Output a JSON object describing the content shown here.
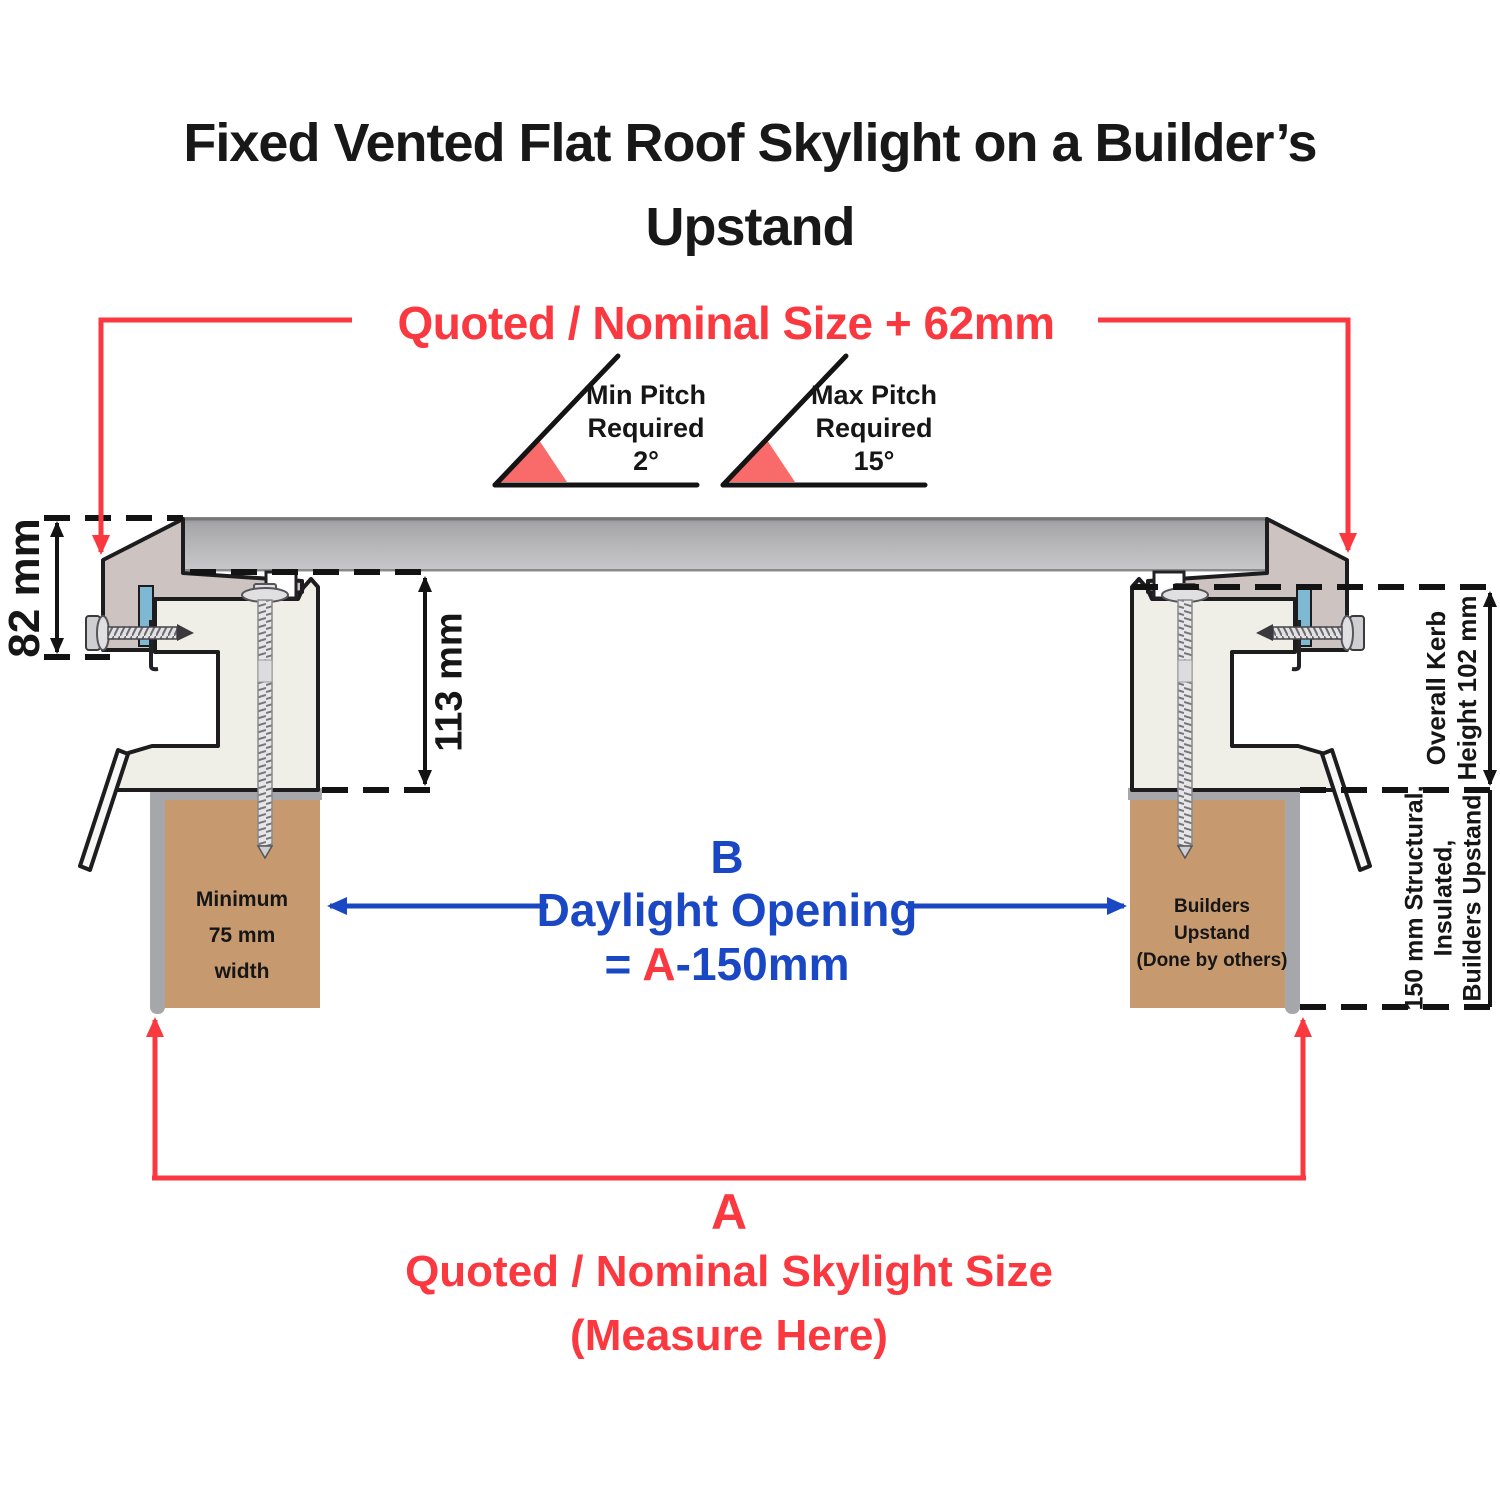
{
  "title": {
    "line1": "Fixed Vented Flat Roof Skylight on a Builder’s",
    "line2": "Upstand"
  },
  "top_dimension": {
    "label": "Quoted / Nominal Size + 62mm"
  },
  "pitch": {
    "min": {
      "line1": "Min Pitch",
      "line2": "Required",
      "value": "2°"
    },
    "max": {
      "line1": "Max Pitch",
      "line2": "Required",
      "value": "15°"
    }
  },
  "dimensions": {
    "frame_height": "82 mm",
    "kerb_inner_height": "113 mm",
    "overall_kerb": {
      "line1": "Overall Kerb",
      "line2": "Height 102 mm"
    },
    "structural_upstand": {
      "line1": "150 mm Structural,",
      "line2": "Insulated,",
      "line3": "Builders Upstand"
    }
  },
  "daylight": {
    "letter": "B",
    "label": "Daylight Opening",
    "equals": "= ",
    "ref": "A",
    "rest": "-150mm"
  },
  "upstand_left": {
    "line1": "Minimum",
    "line2": "75 mm",
    "line3": "width"
  },
  "upstand_right": {
    "line1": "Builders",
    "line2": "Upstand",
    "line3": "(Done by others)"
  },
  "bottom_dimension": {
    "letter": "A",
    "line1": "Quoted / Nominal Skylight Size",
    "line2": "(Measure Here)"
  },
  "colors": {
    "red": "#F93840",
    "blue": "#1A47C4",
    "wedge": "#F96B6B",
    "brown": "#C6996F",
    "flashing": "#A6A7AB",
    "cream": "#F0EFE7",
    "mauve": "#CDC3C0",
    "gasket": "#7FB8D2",
    "glass": "#B5B5B8",
    "line": "#1A1A1A"
  }
}
